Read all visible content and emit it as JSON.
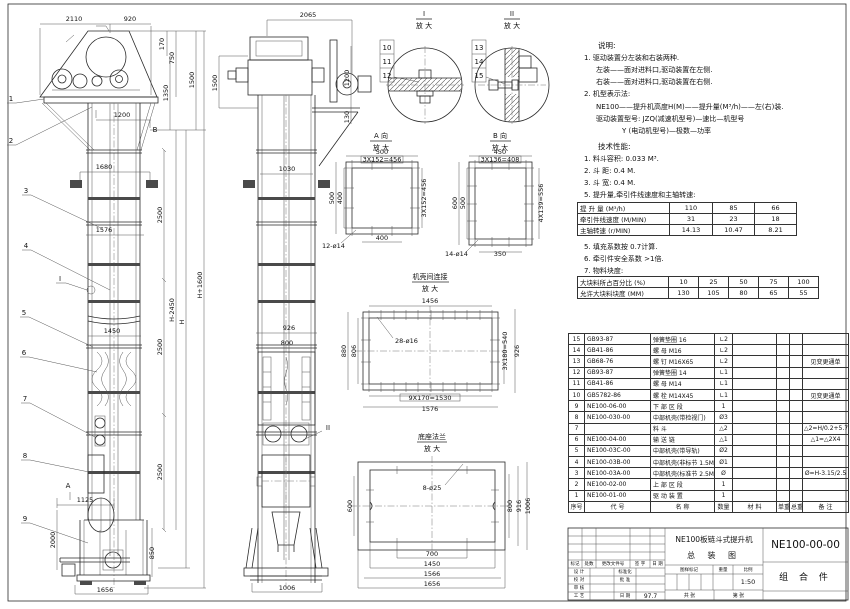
{
  "doc": {
    "title1": "NE100板链斗式提升机",
    "title2": "总  装  图",
    "code": "NE100-00-00",
    "part_type": "组 合 件",
    "scale": "1:50",
    "date": "97.7"
  },
  "notes": {
    "heading": "说明:",
    "n1": "1. 驱动装置分左装和右装两种.",
    "n1a": "左装——面对进料口,驱动装置在左侧.",
    "n1b": "右装——面对进料口,驱动装置在右侧.",
    "n2": "2. 机型表示法:",
    "n2a": "NE100——提升机高度H(M)——提升量(M³/h)——左(右)装.",
    "n2b": "驱动装置型号: JZQ(减速机型号)—速比—机型号",
    "n2c": "Y (电动机型号)—极数—功率"
  },
  "tech": {
    "heading": "技术性能:",
    "t1": "1. 料斗容积: 0.033 M³.",
    "t2": "2. 斗  距: 0.4 M.",
    "t3": "3. 斗  宽: 0.4 M.",
    "t5": "5. 提升量,牵引件线速度和主轴转速:",
    "t5b": "5. 填充系数按 0.7计算.",
    "t6": "6. 牵引件安全系数 >1倍.",
    "t7": "7. 物料块度:",
    "table1": {
      "rows": [
        {
          "label": "提 升 量  (M³/h)",
          "v1": "110",
          "v2": "85",
          "v3": "66"
        },
        {
          "label": "牵引件线速度 (M/MIN)",
          "v1": "31",
          "v2": "23",
          "v3": "18"
        },
        {
          "label": "主轴转速 (r/MIN)",
          "v1": "14.13",
          "v2": "10.47",
          "v3": "8.21"
        }
      ]
    },
    "table2": {
      "rows": [
        {
          "label": "大块料所占百分比 (%)",
          "v1": "10",
          "v2": "25",
          "v3": "50",
          "v4": "75",
          "v5": "100"
        },
        {
          "label": "允许大块料块度 (MM)",
          "v1": "130",
          "v2": "105",
          "v3": "80",
          "v4": "65",
          "v5": "55"
        }
      ]
    }
  },
  "parts": {
    "header": {
      "no": "序号",
      "code": "代    号",
      "name": "名    称",
      "qty": "数量",
      "mat": "材    料",
      "uw": "单重",
      "tw": "总重",
      "rem": "备  注"
    },
    "rows": [
      {
        "no": "15",
        "code": "GB93-87",
        "name": "弹簧垫圈  16",
        "qty": "∟2",
        "mat": "",
        "uw": "",
        "tw": "",
        "rem": ""
      },
      {
        "no": "14",
        "code": "GB41-86",
        "name": "螺 母  M16",
        "qty": "∟2",
        "mat": "",
        "uw": "",
        "tw": "",
        "rem": ""
      },
      {
        "no": "13",
        "code": "GB68-76",
        "name": "螺 钉  M16X65",
        "qty": "∟2",
        "mat": "",
        "uw": "",
        "tw": "",
        "rem": "见变更通单"
      },
      {
        "no": "12",
        "code": "GB93-87",
        "name": "弹簧垫圈  14",
        "qty": "∟1",
        "mat": "",
        "uw": "",
        "tw": "",
        "rem": ""
      },
      {
        "no": "11",
        "code": "GB41-86",
        "name": "螺 母  M14",
        "qty": "∟1",
        "mat": "",
        "uw": "",
        "tw": "",
        "rem": ""
      },
      {
        "no": "10",
        "code": "GB5782-86",
        "name": "螺 栓  M14X45",
        "qty": "∟1",
        "mat": "",
        "uw": "",
        "tw": "",
        "rem": "见变更通单"
      },
      {
        "no": "9",
        "code": "NE100-06-00",
        "name": "下 部 区 段",
        "qty": "1",
        "mat": "",
        "uw": "",
        "tw": "",
        "rem": ""
      },
      {
        "no": "8",
        "code": "NE100-030-00",
        "name": "中部机壳(带检视门)",
        "qty": "Ø3",
        "mat": "",
        "uw": "",
        "tw": "",
        "rem": ""
      },
      {
        "no": "7",
        "code": "NE100-05-00",
        "name": "料 斗",
        "qty": "△2",
        "mat": "",
        "uw": "",
        "tw": "",
        "rem": "△2=H/0.2+5.75"
      },
      {
        "no": "6",
        "code": "NE100-04-00",
        "name": "输 送 链",
        "qty": "△1",
        "mat": "",
        "uw": "",
        "tw": "",
        "rem": "△1=△2X4"
      },
      {
        "no": "5",
        "code": "NE100-03C-00",
        "name": "中部机壳(带导轨)",
        "qty": "Ø2",
        "mat": "",
        "uw": "",
        "tw": "",
        "rem": ""
      },
      {
        "no": "4",
        "code": "NE100-03B-00",
        "name": "中部机壳(非标节 1.5M,1M)",
        "qty": "Ø1",
        "mat": "",
        "uw": "",
        "tw": "",
        "rem": ""
      },
      {
        "no": "3",
        "code": "NE100-03A-00",
        "name": "中部机壳(标准节 2.5M)",
        "qty": "Ø",
        "mat": "",
        "uw": "",
        "tw": "",
        "rem": "Ø=H-3.15/2.5"
      },
      {
        "no": "2",
        "code": "NE100-02-00",
        "name": "上 部 区 段",
        "qty": "1",
        "mat": "",
        "uw": "",
        "tw": "",
        "rem": ""
      },
      {
        "no": "1",
        "code": "NE100-01-00",
        "name": "驱 动 装 置",
        "qty": "1",
        "mat": "",
        "uw": "",
        "tw": "",
        "rem": ""
      }
    ]
  },
  "tb": {
    "c1": "标记",
    "c2": "处数",
    "c3": "更改文件号",
    "c4": "签 字",
    "c5": "日 期",
    "r1a": "设 计",
    "r1b": "标准化",
    "r2a": "校 对",
    "r2b": "批 准",
    "r3a": "审 核",
    "r4a": "工 艺",
    "r4b": "日 期",
    "r4c": "97.7",
    "s1": "图样标记",
    "s2": "重量",
    "s3": "比例",
    "scale": "1:50",
    "sheets": "共      张",
    "page": "第      张"
  },
  "v": {
    "front": {
      "d2110": "2110",
      "d920": "920",
      "d170": "170",
      "d750": "750",
      "d1350": "1350",
      "d1500": "1500",
      "d1200": "1200",
      "mB": "B",
      "d1680": "1680",
      "d1576": "1576",
      "d1450": "1450",
      "d1125": "1125",
      "d2000": "2000",
      "d850": "850",
      "d1656": "1656",
      "d2500a": "2500",
      "d2500b": "2500",
      "d2500c": "2500",
      "dHp": "H+1600",
      "dHm": "H-2450",
      "dH": "H",
      "mA": "A",
      "mI": "I",
      "b": [
        "1",
        "2",
        "3",
        "4",
        "5",
        "6",
        "7",
        "8",
        "9"
      ]
    },
    "side": {
      "d2065": "2065",
      "d1500": "1500",
      "d1200": "1200",
      "d130": "130",
      "d1030": "1030",
      "d926": "926",
      "d800": "800",
      "d1006": "1006",
      "mII": "II"
    },
    "di": {
      "t": "I",
      "s": "放 大",
      "b1": "10",
      "b2": "11",
      "b3": "12"
    },
    "dii": {
      "t": "II",
      "s": "放 大",
      "b1": "13",
      "b2": "14",
      "b3": "15"
    },
    "va": {
      "t": "A 向",
      "s": "放 大",
      "a": "500",
      "b": "3X152=456",
      "c": "500",
      "d": "400",
      "e": "400",
      "f": "3X152=456",
      "g": "12-ø14"
    },
    "vb": {
      "t": "B 向",
      "s": "放 大",
      "a": "450",
      "b": "3X136=408",
      "c": "600",
      "d": "500",
      "e": "350",
      "f": "4X139=556",
      "g": "14-ø14"
    },
    "fl": {
      "t": "机壳间连接",
      "s": "放 大",
      "a": "1456",
      "b": "28-ø16",
      "c": "880",
      "d": "806",
      "e": "3X180=540",
      "f": "926",
      "g": "9X170=1530",
      "h": "1576"
    },
    "bs": {
      "t": "底座法兰",
      "s": "放 大",
      "a": "8-ø25",
      "b": "600",
      "c": "800",
      "d": "916",
      "e": "1006",
      "f": "700",
      "g": "1450",
      "h": "1566",
      "i": "1656"
    }
  }
}
